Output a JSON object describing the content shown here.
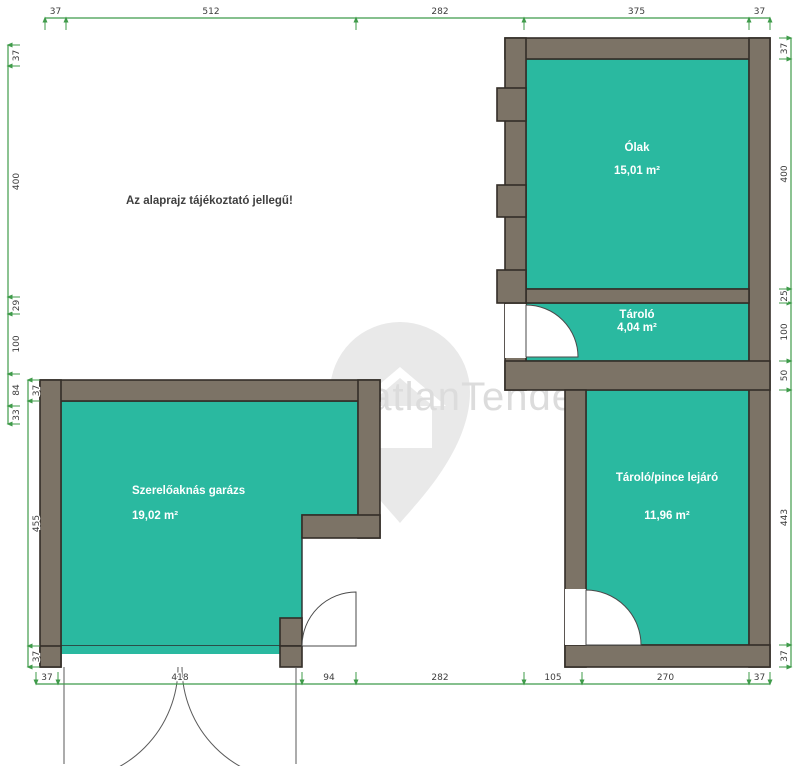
{
  "watermark": {
    "text": "IngatlanTender"
  },
  "disclaimer": "Az alaprajz tájékoztató jellegű!",
  "rooms": {
    "olak": {
      "name": "Ólak",
      "area": "15,01 m²"
    },
    "tarolo": {
      "name": "Tároló",
      "area": "4,04 m²"
    },
    "tarolo_pince": {
      "name": "Tároló/pince lejáró",
      "area": "11,96 m²"
    },
    "garazs": {
      "name": "Szerelőaknás garázs",
      "area": "19,02 m²"
    }
  },
  "dims": {
    "top": [
      "37",
      "512",
      "282",
      "375",
      "37"
    ],
    "bottom": [
      "37",
      "418",
      "94",
      "282",
      "105",
      "270",
      "37"
    ],
    "left": [
      "37",
      "400",
      "29",
      "100",
      "84",
      "33"
    ],
    "garage_left": [
      "37",
      "455",
      "37"
    ],
    "right": [
      "37",
      "400",
      "25",
      "100",
      "50",
      "443",
      "37"
    ]
  },
  "colors": {
    "room_fill": "#2ab9a0",
    "wall_fill": "#7c7366",
    "dimension_green": "#3f9b4a",
    "watermark_gray": "#e9e9e9"
  }
}
